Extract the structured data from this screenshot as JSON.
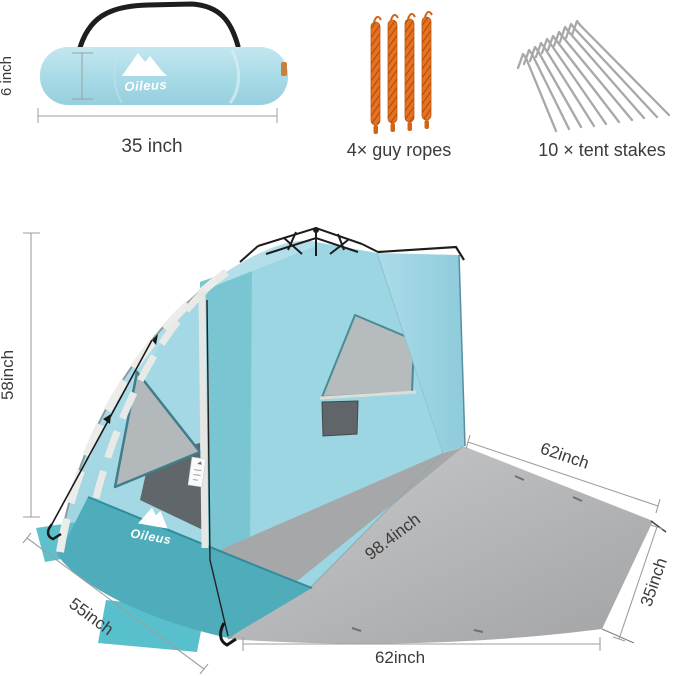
{
  "bag": {
    "brand": "Oileus",
    "height_label": "6 inch",
    "width_label": "35 inch"
  },
  "guy_ropes": {
    "label": "4× guy ropes"
  },
  "tent_stakes": {
    "label": "10 × tent stakes"
  },
  "tent": {
    "brand": "Oileus",
    "height_label": "58inch",
    "mat_top_label": "62inch",
    "diagonal_label": "98.4inch",
    "mat_side_label": "35inch",
    "front_edge_label": "55inch",
    "mat_bottom_label": "62inch"
  },
  "colors": {
    "tent_light_blue": "#a9dbe7",
    "tent_teal": "#4fadbb",
    "rope_orange": "#e8701e",
    "stake_gray": "#a8a8a8",
    "mat_gray": "#b4b5b7",
    "dimension_text": "#3b3b3b"
  }
}
